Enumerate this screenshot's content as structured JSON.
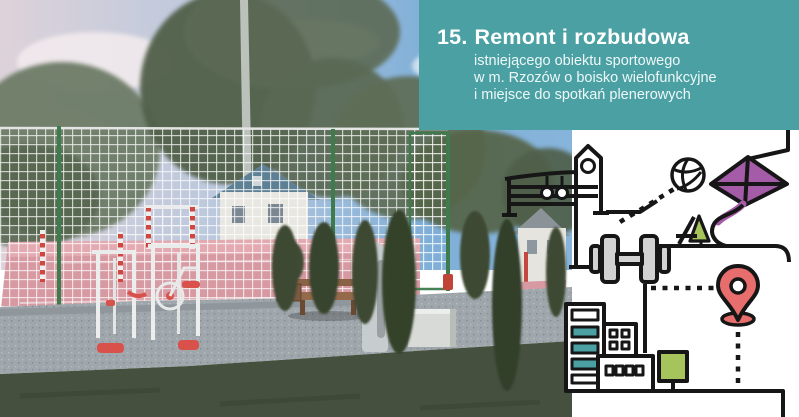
{
  "banner": {
    "number_prefix": "15.",
    "title": "Remont i rozbudowa",
    "subtitle_lines": [
      "istniejącego obiektu sportowego",
      "w m. Rzozów o boisko wielofunkcyjne",
      "i miejsce do spotkań plenerowych"
    ]
  },
  "icons": {
    "list": [
      "playground-structure-icon",
      "volleyball-icon",
      "kite-icon",
      "tent-tree-icon",
      "dumbbell-icon",
      "location-pin-icon",
      "city-buildings-icon",
      "square-tree-icon",
      "route-line"
    ]
  },
  "colors": {
    "teal": "#4AA0A3",
    "kite": "#A55CA8",
    "pin": "#E86D6D",
    "tree": "#A7C45C",
    "metal": "#D2D2D2",
    "ink": "#161616"
  }
}
